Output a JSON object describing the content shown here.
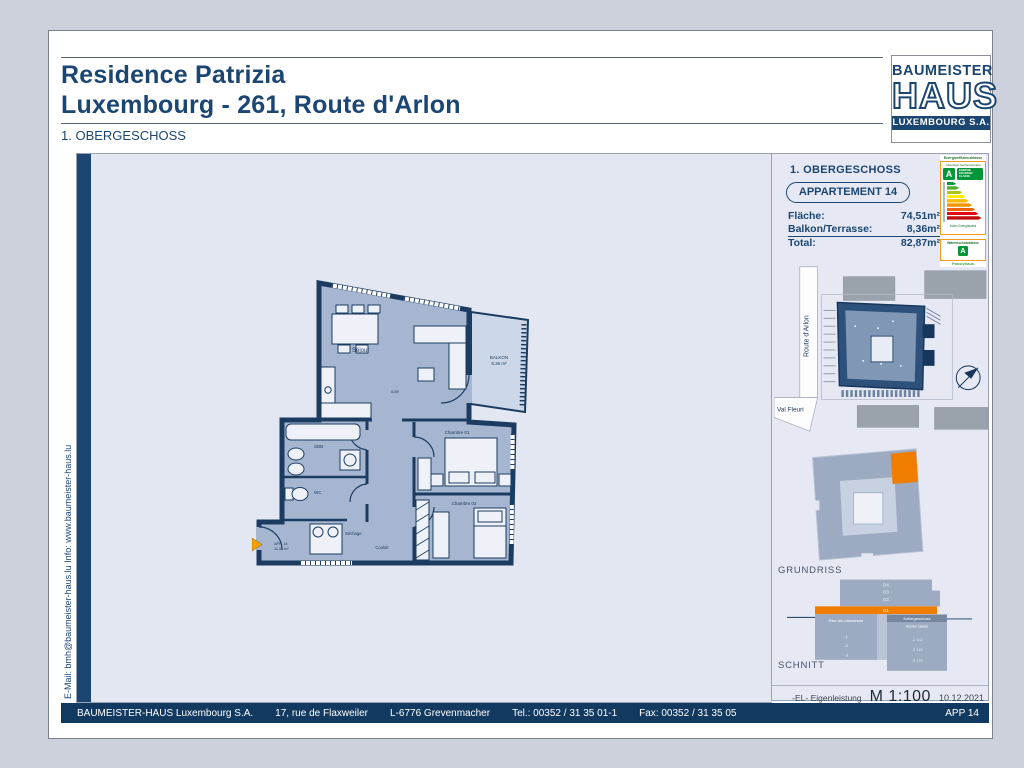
{
  "page": {
    "title1": "Residence Patrizia",
    "title2": "Luxembourg - 261, Route d'Arlon",
    "floor_label": "1. OBERGESCHOSS"
  },
  "logo": {
    "line1": "BAUMEISTER",
    "line2": "HAUS",
    "line3": "LUXEMBOURG S.A."
  },
  "gutter_text": "E-Mail: bmh@baumeister-haus.lu       Info:       www.baumeister-haus.lu",
  "info_panel": {
    "floor": "1. OBERGESCHOSS",
    "apartment": "APPARTEMENT 14",
    "rows": [
      {
        "label": "Fläche:",
        "value": "74,51m²"
      },
      {
        "label": "Balkon/Terrasse:",
        "value": "8,36m²"
      },
      {
        "label": "Total:",
        "value": "82,87m²"
      }
    ]
  },
  "energy_label": {
    "title": "Energieeffizienzklasse",
    "subtitle": "zukünftiger Neubaustandard",
    "class_letter": "A",
    "badge_line1": "ENERGIE",
    "badge_line2": "EFFIZIENZ",
    "badge_line3": "KLASSE",
    "bar_colors": [
      "#009640",
      "#52ae32",
      "#a8c813",
      "#ffed00",
      "#fbba00",
      "#f39200",
      "#ec6608",
      "#e30613",
      "#c00d0d"
    ],
    "footer": "Index Energiepass",
    "box2_title": "Wärmeschutzklasse",
    "box2_class": "A",
    "box2_footer": "Passivhaus",
    "border_color": "#f39b1f",
    "green": "#009639"
  },
  "site_plan": {
    "street_vertical": "Route d'Arlon",
    "street_bottom": "Val Fleuri"
  },
  "grundriss": {
    "label": "GRUNDRISS",
    "highlight_color": "#f07d00"
  },
  "schnitt": {
    "label": "SCHNITT",
    "floors": [
      "04",
      "03",
      "02",
      "01"
    ],
    "left_title": "Rez-de-chaussée",
    "left_levels": [
      "-1",
      "-2",
      "-3"
    ],
    "right_title1": "Kellergeschoss",
    "right_title2": "Accès caves",
    "right_levels": [
      "-1 1/2",
      "-2 1/2",
      "-3 1/2"
    ]
  },
  "annotations": {
    "eigenleistung": "-EL- Eigenleistung",
    "scale": "M 1:100",
    "date": "10.12.2021"
  },
  "footer": {
    "company": "BAUMEISTER-HAUS Luxembourg S.A.",
    "address": "17, rue de Flaxweiler",
    "city": "L-6776 Grevenmacher",
    "tel": "Tel.: 00352 / 31 35 01-1",
    "fax": "Fax: 00352 / 31 35 05",
    "sheet": "APP 14"
  },
  "floor_plan": {
    "sejour": "Séjour",
    "balkon1": "BALKON",
    "balkon2": "8,36 m²",
    "sdb": "SDB",
    "wc": "WC",
    "sechage": "Séchage",
    "couloir": "Couloir",
    "chambre1": "Chambre 01",
    "chambre2": "Chambre 02",
    "entrance1": "APP. 14",
    "entrance2": "11,01 m²",
    "dim1": "5,89",
    "wall_color": "#1b3c60",
    "room_fill": "#a6b6d0",
    "balcony_fill": "#ccd8e9",
    "entrance_arrow_color": "#f5a300"
  }
}
